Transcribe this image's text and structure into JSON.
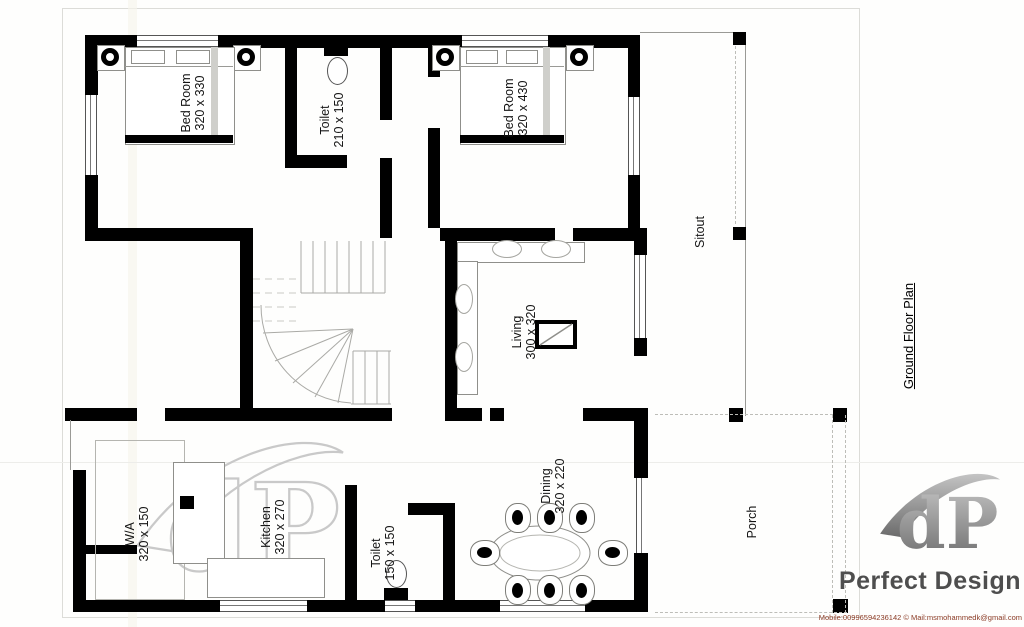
{
  "title": "Ground Floor Plan",
  "rooms": [
    {
      "name": "Bed Room",
      "dims": "320 x 330"
    },
    {
      "name": "Toilet",
      "dims": "210 x 150"
    },
    {
      "name": "Bed Room",
      "dims": "320 x 430"
    },
    {
      "name": "Sitout",
      "dims": ""
    },
    {
      "name": "Living",
      "dims": "300 x 320"
    },
    {
      "name": "W/A",
      "dims": "320 x 150"
    },
    {
      "name": "Kitchen",
      "dims": "320 x 270"
    },
    {
      "name": "Toilet",
      "dims": "150 x 150"
    },
    {
      "name": "Dining",
      "dims": "320 x 220"
    },
    {
      "name": "Porch",
      "dims": ""
    }
  ],
  "branding": {
    "company": "Perfect Design",
    "monogram": "dP",
    "contact": "Mobile:00996594236142 © Mail:msmohammedk@gmail.com"
  },
  "colors": {
    "wall": "#000000",
    "window_outline": "#555555",
    "furniture_outline": "#8f8f8b",
    "dashed_line": "#bdbdb8",
    "watermark": "#c9c9c9",
    "logo_gray": "#4e4e4e",
    "contact_text": "#8a3a24"
  }
}
